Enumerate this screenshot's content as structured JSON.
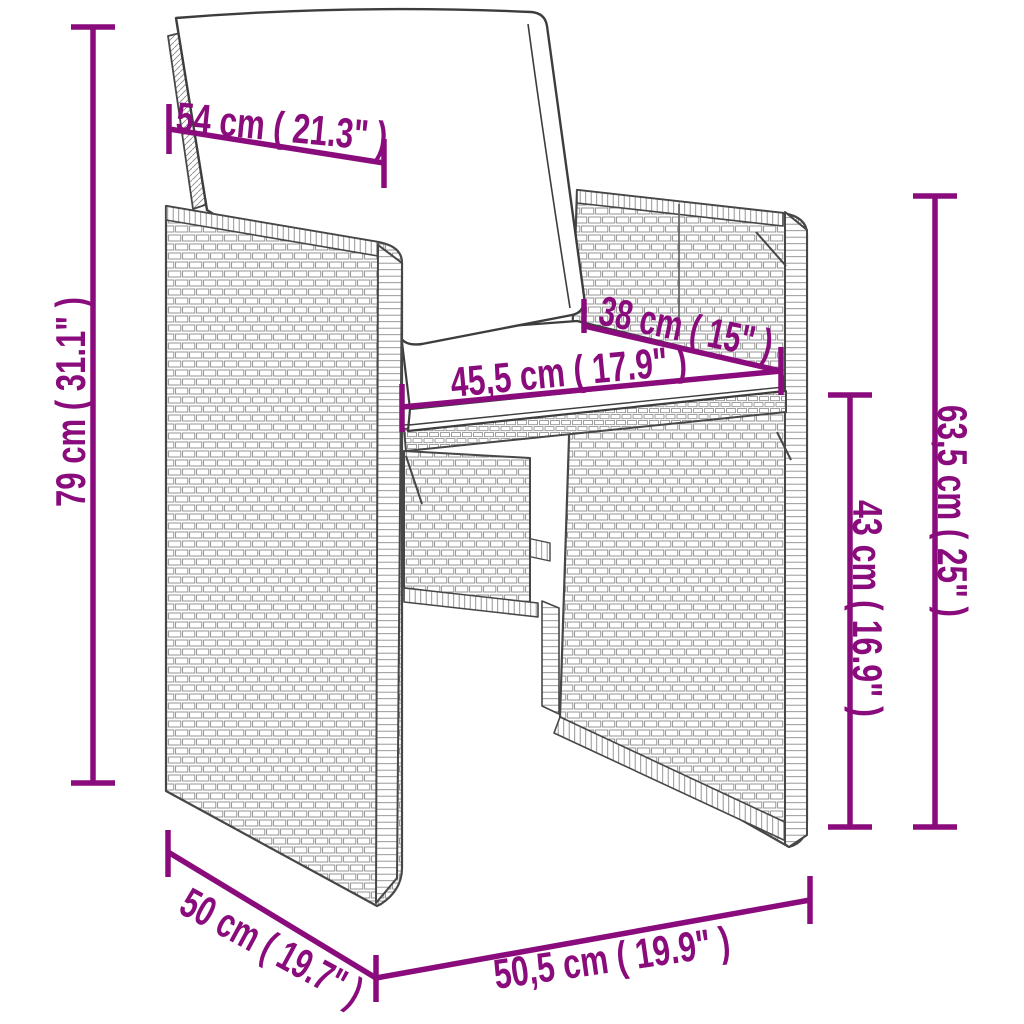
{
  "page": {
    "background": "#ffffff"
  },
  "diagram": {
    "kind": "product dimension drawing",
    "subject": "poly rattan garden chair with seat and back cushions",
    "accent_color": "#8A0C7C",
    "outline_color": "#474747",
    "weave_color": "#8a8a8a",
    "dimensions": [
      {
        "id": "backrest-width",
        "label": "54 cm ( 21.3\" )"
      },
      {
        "id": "total-height",
        "label": "79 cm ( 31.1\" )"
      },
      {
        "id": "seat-depth",
        "label": "38 cm ( 15\" )"
      },
      {
        "id": "seat-width",
        "label": "45,5 cm ( 17.9\" )"
      },
      {
        "id": "armrest-height",
        "label": "63,5 cm ( 25\" )"
      },
      {
        "id": "seat-height",
        "label": "43 cm ( 16.9\" )"
      },
      {
        "id": "side-depth",
        "label": "50 cm ( 19.7\" )"
      },
      {
        "id": "front-width",
        "label": "50,5 cm ( 19.9\" )"
      }
    ]
  }
}
